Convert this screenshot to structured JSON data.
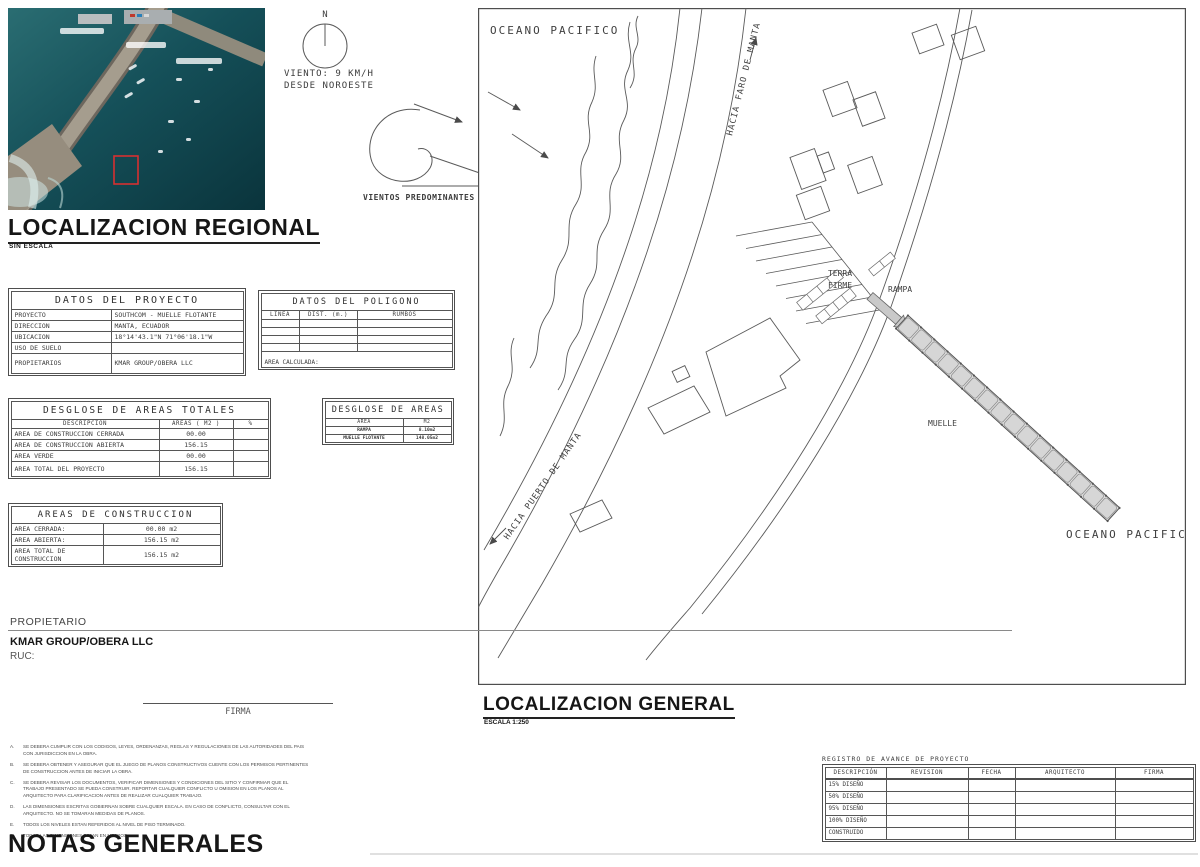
{
  "regional": {
    "title": "LOCALIZACION REGIONAL",
    "subtitle": "SIN ESCALA"
  },
  "compass": {
    "north_label": "N"
  },
  "wind": {
    "line1": "VIENTO: 9 KM/H",
    "line2": "DESDE NOROESTE",
    "predominant_label": "VIENTOS PREDOMINANTES"
  },
  "map": {
    "ocean_top_label": "OCEANO PACIFICO",
    "ocean_bottom_label": "OCEANO PACIFICO",
    "to_faro_label": "HACIA FARO DE MANTA",
    "to_puerto_label": "HACIA PUERTO DE MANTA",
    "terra_firme_line1": "TERRA",
    "terra_firme_line2": "FIRME",
    "rampa_label": "RAMPA",
    "muelle_label": "MUELLE"
  },
  "general": {
    "title": "LOCALIZACION GENERAL",
    "scale": "ESCALA 1:250"
  },
  "project_table": {
    "title": "DATOS DEL PROYECTO",
    "rows": [
      {
        "label": "PROYECTO",
        "value": "SOUTHCOM - MUELLE FLOTANTE"
      },
      {
        "label": "DIRECCION",
        "value": "MANTA, ECUADOR"
      },
      {
        "label": "UBICACION",
        "value": "18°14'43.1\"N  71°06'18.1\"W"
      },
      {
        "label": "USO DE SUELO",
        "value": ""
      },
      {
        "label": "PROPIETARIOS",
        "value": "KMAR GROUP/OBERA LLC"
      }
    ]
  },
  "polygon_table": {
    "title": "DATOS DEL POLIGONO",
    "headers": [
      "LINEA",
      "DIST. (m.)",
      "RUMBOS"
    ],
    "footer": "AREA CALCULADA:"
  },
  "areas_totals_table": {
    "title": "DESGLOSE DE AREAS TOTALES",
    "headers": [
      "DESCRIPCION",
      "AREAS ( M2 )",
      "%"
    ],
    "rows": [
      {
        "desc": "AREA DE CONSTRUCCION CERRADA",
        "area": "00.00",
        "pct": ""
      },
      {
        "desc": "AREA DE CONSTRUCCION ABIERTA",
        "area": "156.15",
        "pct": ""
      },
      {
        "desc": "AREA VERDE",
        "area": "00.00",
        "pct": ""
      },
      {
        "desc": "AREA TOTAL DEL PROYECTO",
        "area": "156.15",
        "pct": ""
      }
    ]
  },
  "areas_breakdown_table": {
    "title": "DESGLOSE DE AREAS",
    "headers": [
      "AREA",
      "M2"
    ],
    "rows": [
      {
        "area": "RAMPA",
        "m2": "8.10m2"
      },
      {
        "area": "MUELLE FLOTANTE",
        "m2": "148.05m2"
      }
    ]
  },
  "construction_table": {
    "title": "AREAS DE CONSTRUCCION",
    "rows": [
      {
        "label": "AREA CERRADA:",
        "value": "00.00 m2"
      },
      {
        "label": "AREA ABIERTA:",
        "value": "156.15 m2"
      },
      {
        "label": "AREA TOTAL DE CONSTRUCCION",
        "value": "156.15 m2"
      }
    ]
  },
  "owner": {
    "label": "PROPIETARIO",
    "name": "KMAR GROUP/OBERA LLC",
    "ruc_label": "RUC:",
    "signature_label": "FIRMA"
  },
  "notes": {
    "title": "NOTAS GENERALES",
    "items": [
      {
        "letter": "A.",
        "text": "SE DEBERA CUMPLIR CON LOS CODIGOS, LEYES, ORDENANZAS, REGLAS Y REGULACIONES DE LAS AUTORIDADES DEL PAIS CON JURISDICCION EN LA OBRA."
      },
      {
        "letter": "B.",
        "text": "SE DEBERA OBTENER Y ASEGURAR QUE EL JUEGO DE PLANOS CONSTRUCTIVOS CUENTE CON LOS PERMISOS PERTINENTES DE CONSTRUCCION ANTES DE INICIAR LA OBRA."
      },
      {
        "letter": "C.",
        "text": "SE DEBERA REVISAR LOS DOCUMENTOS, VERIFICAR DIMENSIONES Y CONDICIONES DEL SITIO Y CONFIRMAR QUE EL TRABAJO PRESENTADO SE PUEDA CONSTRUIR. REPORTAR CUALQUIER CONFLICTO U OMISION EN LOS PLANOS AL ARQUITECTO PARA CLARIFICACION ANTES DE REALIZAR CUALQUIER TRABAJO."
      },
      {
        "letter": "D.",
        "text": "LAS DIMENSIONES ESCRITAS GOBIERNAN SOBRE CUALQUIER ESCALA. EN CASO DE CONFLICTO, CONSULTAR CON EL ARQUITECTO. NO SE TOMARAN MEDIDAS DE PLANOS."
      },
      {
        "letter": "E.",
        "text": "TODOS LOS NIVELES ESTAN REFERIDOS AL NIVEL DE PISO TERMINADO."
      },
      {
        "letter": "F.",
        "text": "TODAS LAS DIMENSIONES ESTAN EN METROS."
      }
    ]
  },
  "progress_table": {
    "title": "REGISTRO DE AVANCE DE PROYECTO",
    "headers": [
      "DESCRIPCIÓN",
      "REVISION",
      "FECHA",
      "ARQUITECTO",
      "FIRMA"
    ],
    "rows": [
      "15% DISEÑO",
      "50% DISEÑO",
      "95% DISEÑO",
      "100% DISEÑO",
      "CONSTRUIDO"
    ]
  },
  "colors": {
    "line": "#555555",
    "pier_fill": "#d6d6d6",
    "water": "#14525a",
    "highlight": "#d63031"
  }
}
